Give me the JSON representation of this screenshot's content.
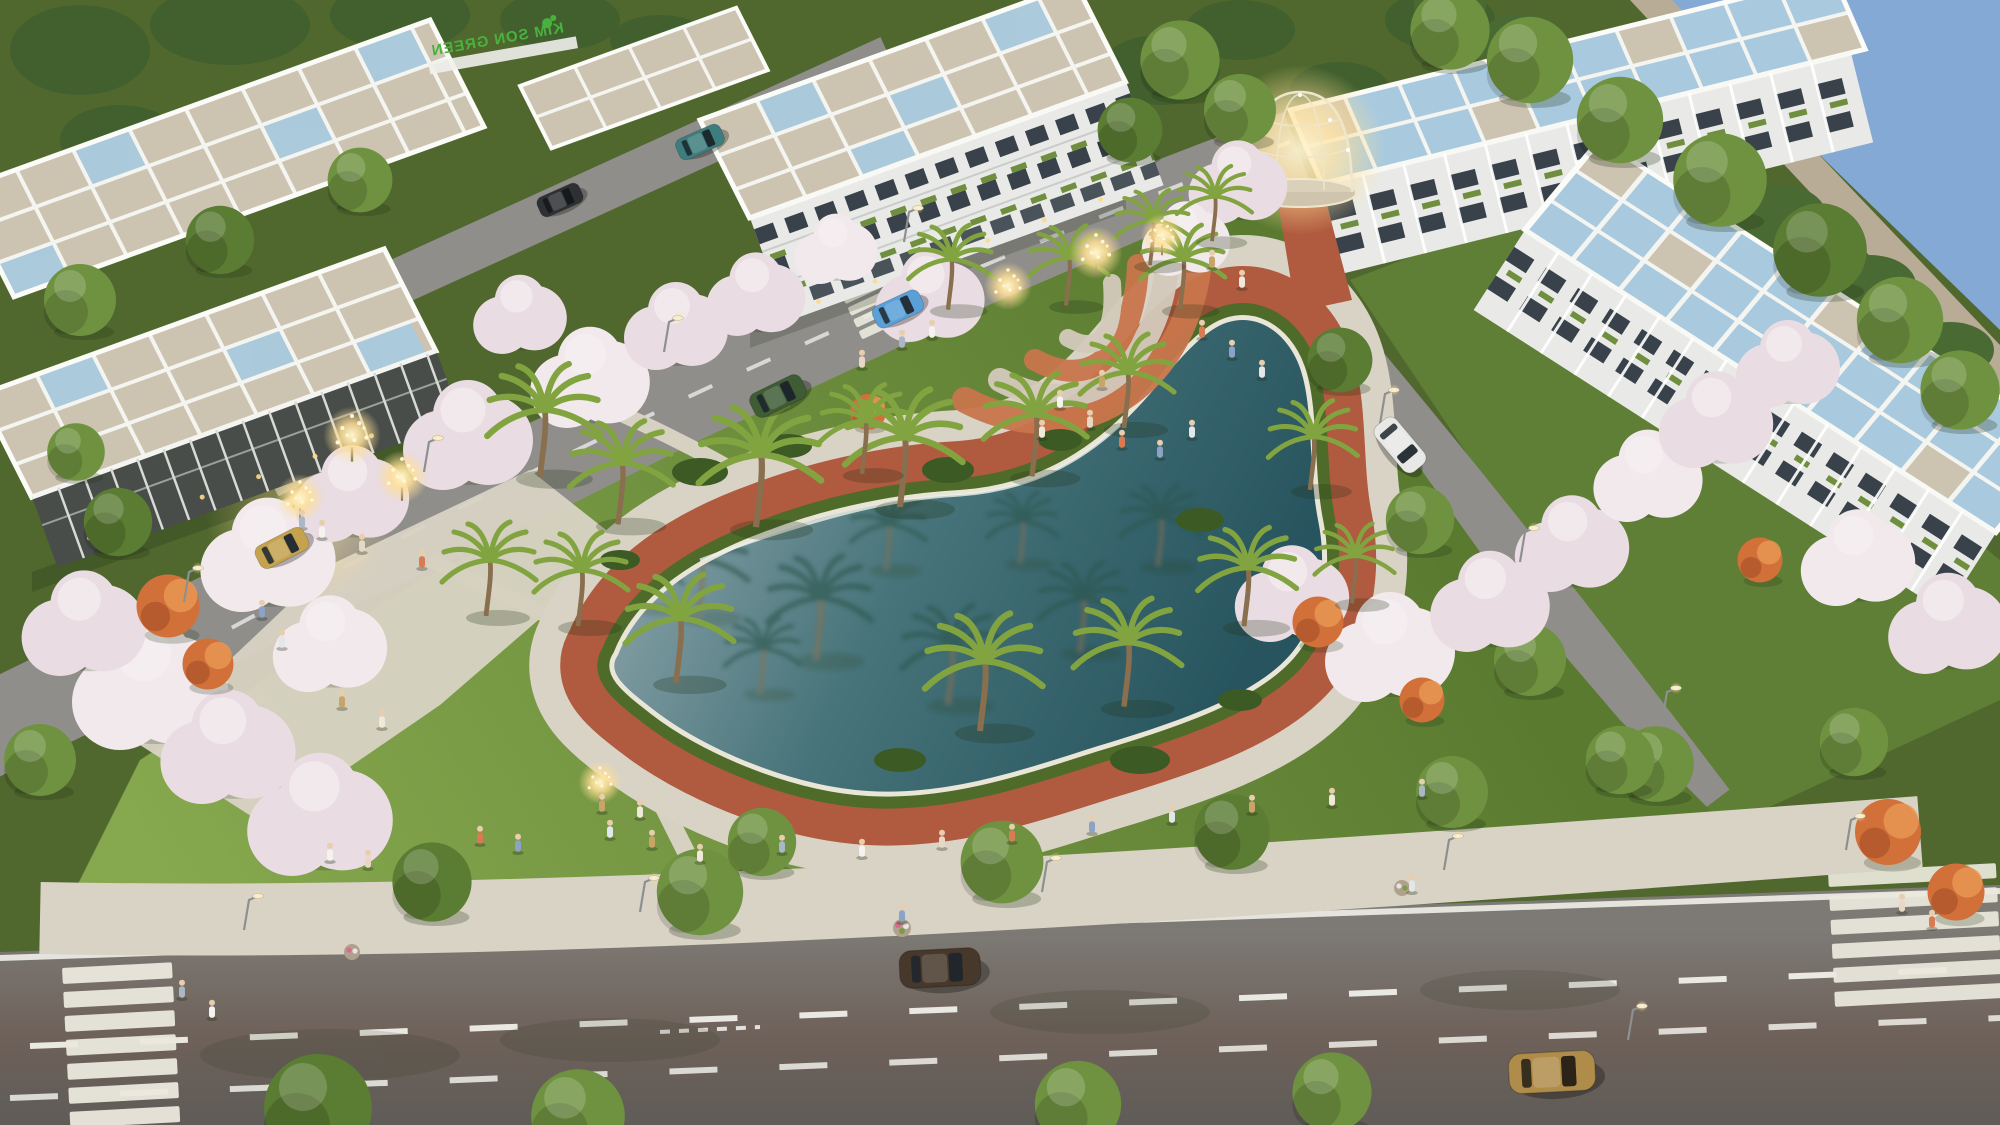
{
  "meta": {
    "width": 2000,
    "height": 1125
  },
  "sign": {
    "text": "KIM SON GREEN",
    "note": "mirrored green rooftop lettering",
    "color": "#49b23f"
  },
  "palette": {
    "lake_deep": "#27545e",
    "lake_mid": "#47747a",
    "lake_light": "#8ea6ac",
    "grass": "#6d8d3e",
    "grass_light": "#86a84e",
    "grass_dark": "#55702c",
    "track_brick": "#b05a3f",
    "promenade_stone": "#d9d3c5",
    "hedge": "#4e6b2a",
    "asphalt_dark": "#67645f",
    "asphalt_light": "#8f8e8a",
    "roof_beige": "#cdc3b1",
    "roof_glass": "#a9cade",
    "facade_white": "#e9eae7",
    "facade_dark": "#484d49",
    "window_dark": "#39424a",
    "blossom_pink": "#e9dce2",
    "flame_orange": "#d2703a",
    "tree_green": "#6f9240",
    "palm_green": "#82a440",
    "palm_reflection": "#2c544c",
    "glow_warm": "#ffdf96",
    "corner_water_blue": "#84a9d4",
    "corner_wall_tan": "#b8ac97",
    "crosswalk_white": "#eceade",
    "lane_line": "#f0efe9"
  },
  "scenery": {
    "palms": [
      [
        540,
        472,
        2.4
      ],
      [
        618,
        520,
        2.2
      ],
      [
        756,
        522,
        2.6
      ],
      [
        900,
        502,
        2.5
      ],
      [
        1032,
        472,
        2.2
      ],
      [
        1124,
        424,
        2.0
      ],
      [
        676,
        678,
        2.3
      ],
      [
        578,
        622,
        2.0
      ],
      [
        980,
        726,
        2.5
      ],
      [
        1124,
        702,
        2.3
      ],
      [
        1244,
        622,
        2.1
      ],
      [
        1310,
        486,
        1.9
      ],
      [
        1180,
        306,
        1.8
      ],
      [
        1066,
        302,
        1.7
      ],
      [
        948,
        306,
        1.8
      ],
      [
        486,
        612,
        2.0
      ],
      [
        1212,
        238,
        1.6
      ],
      [
        862,
        470,
        1.9
      ],
      [
        1352,
        600,
        1.7
      ],
      [
        1150,
        262,
        1.6
      ]
    ],
    "palm_reflections": [
      [
        698,
        612,
        2.0
      ],
      [
        816,
        655,
        2.2
      ],
      [
        948,
        700,
        2.1
      ],
      [
        1080,
        648,
        1.9
      ],
      [
        1158,
        562,
        1.7
      ],
      [
        886,
        566,
        1.6
      ],
      [
        648,
        606,
        1.4
      ],
      [
        1020,
        560,
        1.5
      ],
      [
        760,
        690,
        1.6
      ]
    ],
    "blossoms": [
      [
        268,
        560,
        2.6
      ],
      [
        352,
        498,
        2.2
      ],
      [
        468,
        440,
        2.5
      ],
      [
        590,
        382,
        2.3
      ],
      [
        676,
        330,
        2.0
      ],
      [
        756,
        298,
        1.9
      ],
      [
        150,
        690,
        3.0
      ],
      [
        84,
        628,
        2.4
      ],
      [
        228,
        752,
        2.6
      ],
      [
        330,
        648,
        2.2
      ],
      [
        320,
        820,
        2.8
      ],
      [
        1292,
        598,
        2.2
      ],
      [
        1390,
        652,
        2.5
      ],
      [
        1490,
        606,
        2.3
      ],
      [
        1572,
        548,
        2.2
      ],
      [
        1648,
        480,
        2.1
      ],
      [
        1716,
        424,
        2.2
      ],
      [
        1788,
        368,
        2.0
      ],
      [
        1858,
        562,
        2.2
      ],
      [
        1948,
        628,
        2.3
      ],
      [
        1238,
        186,
        1.9
      ],
      [
        1186,
        242,
        1.7
      ],
      [
        520,
        318,
        1.8
      ],
      [
        930,
        300,
        2.1
      ],
      [
        836,
        252,
        1.6
      ]
    ],
    "green_trees": [
      [
        432,
        882,
        2.2
      ],
      [
        700,
        892,
        2.4
      ],
      [
        762,
        842,
        1.9
      ],
      [
        1002,
        862,
        2.3
      ],
      [
        1232,
        832,
        2.1
      ],
      [
        1452,
        792,
        2.0
      ],
      [
        1656,
        764,
        2.1
      ],
      [
        1854,
        742,
        1.9
      ],
      [
        318,
        1108,
        3.0
      ],
      [
        578,
        1116,
        2.6
      ],
      [
        1078,
        1104,
        2.4
      ],
      [
        1332,
        1092,
        2.2
      ],
      [
        118,
        522,
        1.9
      ],
      [
        76,
        452,
        1.6
      ],
      [
        40,
        760,
        2.0
      ],
      [
        80,
        300,
        2.0
      ],
      [
        220,
        240,
        1.9
      ],
      [
        360,
        180,
        1.8
      ],
      [
        1180,
        60,
        2.2
      ],
      [
        1240,
        110,
        2.0
      ],
      [
        1130,
        130,
        1.8
      ],
      [
        1530,
        60,
        2.4
      ],
      [
        1620,
        120,
        2.4
      ],
      [
        1720,
        180,
        2.6
      ],
      [
        1820,
        250,
        2.6
      ],
      [
        1900,
        320,
        2.4
      ],
      [
        1960,
        390,
        2.2
      ],
      [
        1450,
        30,
        2.2
      ],
      [
        1340,
        360,
        1.8
      ],
      [
        1420,
        520,
        1.9
      ],
      [
        1530,
        660,
        2.0
      ],
      [
        1620,
        760,
        1.9
      ]
    ],
    "flame_trees": [
      [
        168,
        606,
        2.1
      ],
      [
        208,
        664,
        1.7
      ],
      [
        1318,
        622,
        1.7
      ],
      [
        1422,
        700,
        1.5
      ],
      [
        1888,
        832,
        2.2
      ],
      [
        1956,
        892,
        1.9
      ],
      [
        868,
        412,
        1.2
      ],
      [
        1760,
        560,
        1.5
      ]
    ],
    "glow_trees": [
      [
        352,
        452,
        1.2
      ],
      [
        402,
        492,
        1.1
      ],
      [
        300,
        512,
        1.0
      ],
      [
        1096,
        268,
        1.1
      ],
      [
        1008,
        300,
        1.0
      ],
      [
        1162,
        248,
        0.9
      ],
      [
        600,
        795,
        0.9
      ]
    ],
    "lamps": [
      [
        244,
        930
      ],
      [
        640,
        912
      ],
      [
        1042,
        892
      ],
      [
        1444,
        870
      ],
      [
        1846,
        850
      ],
      [
        184,
        602
      ],
      [
        424,
        472
      ],
      [
        664,
        352
      ],
      [
        904,
        242
      ],
      [
        1380,
        424
      ],
      [
        1520,
        562
      ],
      [
        1662,
        722
      ],
      [
        1628,
        1040
      ]
    ],
    "people": [
      [
        330,
        855
      ],
      [
        368,
        862
      ],
      [
        480,
        838
      ],
      [
        518,
        846
      ],
      [
        610,
        832
      ],
      [
        652,
        842
      ],
      [
        700,
        856
      ],
      [
        782,
        847
      ],
      [
        862,
        851
      ],
      [
        942,
        842
      ],
      [
        1012,
        836
      ],
      [
        1092,
        827
      ],
      [
        1172,
        817
      ],
      [
        1252,
        807
      ],
      [
        1332,
        800
      ],
      [
        1422,
        791
      ],
      [
        1060,
        402
      ],
      [
        1090,
        422
      ],
      [
        1122,
        442
      ],
      [
        1160,
        452
      ],
      [
        1192,
        432
      ],
      [
        1102,
        382
      ],
      [
        1042,
        432
      ],
      [
        302,
        522
      ],
      [
        322,
        532
      ],
      [
        362,
        546
      ],
      [
        422,
        562
      ],
      [
        262,
        612
      ],
      [
        282,
        642
      ],
      [
        342,
        702
      ],
      [
        382,
        722
      ],
      [
        902,
        342
      ],
      [
        932,
        332
      ],
      [
        862,
        362
      ],
      [
        1202,
        332
      ],
      [
        1232,
        352
      ],
      [
        1262,
        372
      ],
      [
        1212,
        262
      ],
      [
        1242,
        282
      ],
      [
        182,
        992
      ],
      [
        212,
        1012
      ],
      [
        1902,
        906
      ],
      [
        1932,
        922
      ],
      [
        902,
        916
      ],
      [
        1412,
        886
      ],
      [
        602,
        806
      ],
      [
        640,
        812
      ]
    ],
    "person_colors": [
      "#f4f3ef",
      "#e7d8c6",
      "#d97a52",
      "#8aa3c6",
      "#e2e7ea",
      "#c9a469",
      "#f0e9db",
      "#a9b7c6"
    ]
  },
  "cars": [
    {
      "name": "bronze-sedan",
      "x": 940,
      "y": 968,
      "a": -3,
      "s": 1.5,
      "body": "#46382a",
      "glass": "#20262b"
    },
    {
      "name": "gold-wagon",
      "x": 1552,
      "y": 1072,
      "a": -3,
      "s": 1.6,
      "body": "#b08c4a",
      "glass": "#2b2318"
    },
    {
      "name": "green-hatchback",
      "x": 778,
      "y": 396,
      "a": -26,
      "s": 1.05,
      "body": "#3f5c35",
      "glass": "#1c262b"
    },
    {
      "name": "blue-sedan",
      "x": 898,
      "y": 309,
      "a": -25,
      "s": 0.95,
      "body": "#5aa0d8",
      "glass": "#243038"
    },
    {
      "name": "white-suv",
      "x": 1400,
      "y": 445,
      "a": 50,
      "s": 1.1,
      "body": "#e8e9e6",
      "glass": "#2b3338"
    },
    {
      "name": "gold-coupe",
      "x": 282,
      "y": 548,
      "a": -27,
      "s": 1.0,
      "body": "#c4a24e",
      "glass": "#262e33"
    },
    {
      "name": "dark-sedan",
      "x": 560,
      "y": 200,
      "a": -24,
      "s": 0.85,
      "body": "#2e3134",
      "glass": "#15191c"
    },
    {
      "name": "teal-car",
      "x": 700,
      "y": 142,
      "a": -24,
      "s": 0.9,
      "body": "#3e7d7d",
      "glass": "#1c2a2e"
    }
  ]
}
